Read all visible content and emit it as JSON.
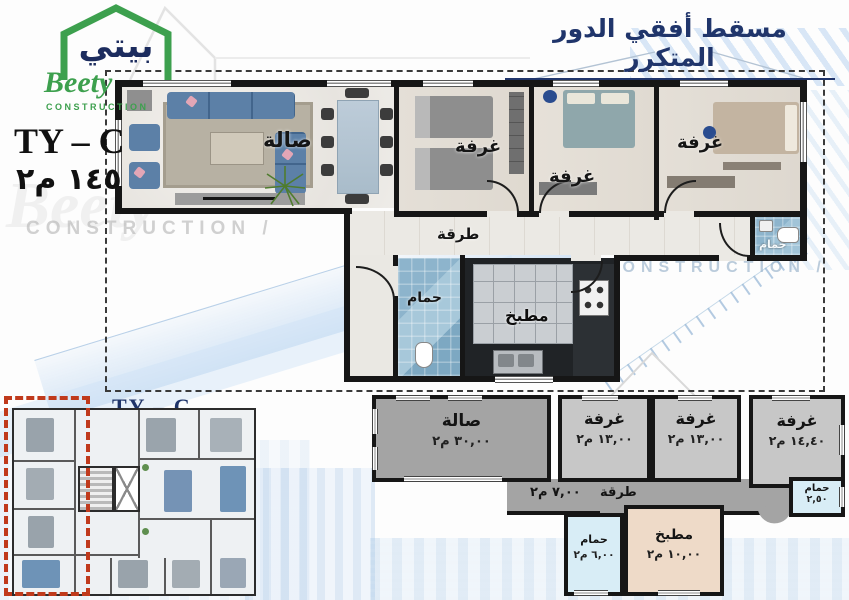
{
  "logo": {
    "arabic_name": "بيتي",
    "latin_name": "Beety",
    "tagline": "CONSTRUCTION"
  },
  "header": {
    "title": "مسقط أفقي الدور المتكرر"
  },
  "unit_info": {
    "model": "TY – C",
    "total_area": "١٤٥ م٢"
  },
  "main_plan": {
    "rooms": {
      "hall": "صالة",
      "bedroom1": "غرفة",
      "bedroom2": "غرفة",
      "bedroom3": "غرفة",
      "corridor": "طرقة",
      "bathroom": "حمام",
      "kitchen": "مطبخ",
      "bathroom2": "حمام"
    }
  },
  "area_schematic": {
    "rooms": [
      {
        "id": "hall",
        "label": "صالة",
        "area": "٣٠,٠٠ م٢"
      },
      {
        "id": "bedroom-1",
        "label": "غرفة",
        "area": "١٣,٠٠ م٢"
      },
      {
        "id": "bedroom-2",
        "label": "غرفة",
        "area": "١٣,٠٠ م٢"
      },
      {
        "id": "bedroom-3",
        "label": "غرفة",
        "area": "١٤,٤٠ م٢"
      },
      {
        "id": "corridor",
        "label": "طرقة",
        "area": "٧,٠٠ م٢"
      },
      {
        "id": "bathroom-right",
        "label": "حمام",
        "area": "٢,٥٠"
      },
      {
        "id": "bathroom-left",
        "label": "حمام",
        "area": "٦,٠٠ م٢"
      },
      {
        "id": "kitchen",
        "label": "مطبخ",
        "area": "١٠,٠٠ م٢"
      }
    ]
  },
  "floor_overview": {
    "model_label": "TY – C"
  },
  "watermarks": {
    "construction_left": "CONSTRUCTION /",
    "construction_right": "CONSTRUCTION /"
  },
  "colors": {
    "accent_navy": "#20356b",
    "logo_green": "#3da04e",
    "highlight_red": "#c03a1c",
    "schematic_dark_gray": "#a4a4a4",
    "schematic_light_gray": "#c7c7c7",
    "schematic_bath_blue": "#d8edf6",
    "schematic_kitchen_beige": "#eedac8",
    "sofa_blue": "#5c80a7"
  }
}
